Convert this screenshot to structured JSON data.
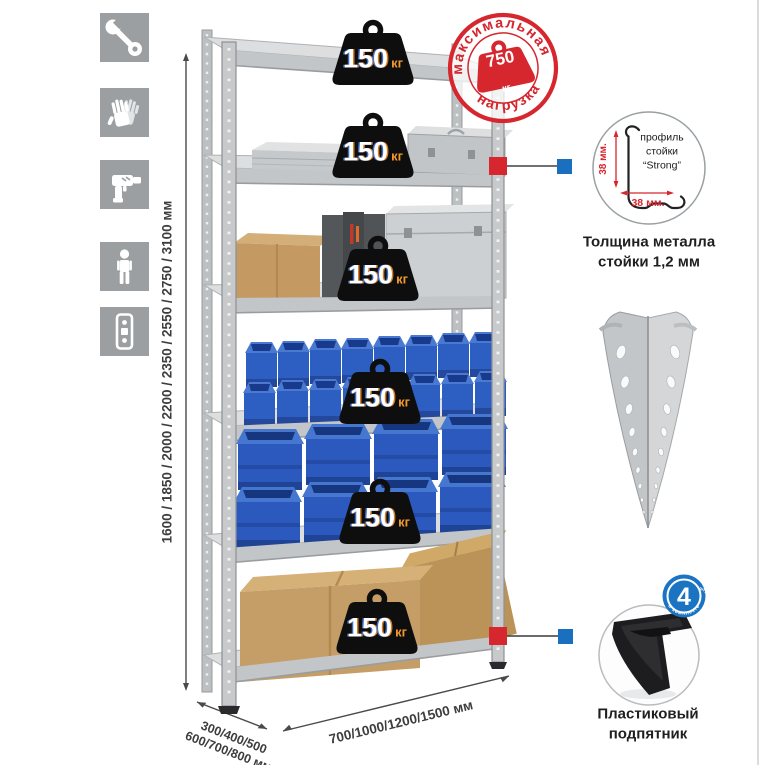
{
  "left_toolbar": {
    "icons": [
      {
        "name": "wrench"
      },
      {
        "name": "gloves"
      },
      {
        "name": "drill"
      },
      {
        "name": "person"
      },
      {
        "name": "level"
      }
    ]
  },
  "dimensions": {
    "height": "1600 / 1850 / 2000 / 2200 / 2350 / 2550 / 2750 / 3100 мм",
    "depth": "300/400/500\n600/700/800 мм",
    "width": "700/1000/1200/1500 мм"
  },
  "rack": {
    "shelves": [
      {
        "load": "150",
        "unit": "кг"
      },
      {
        "load": "150",
        "unit": "кг"
      },
      {
        "load": "150",
        "unit": "кг"
      },
      {
        "load": "150",
        "unit": "кг"
      },
      {
        "load": "150",
        "unit": "кг"
      },
      {
        "load": "150",
        "unit": "кг"
      }
    ]
  },
  "max_load_stamp": {
    "arc_top": "максимальная",
    "arc_bottom": "нагрузка",
    "value": "750",
    "unit": "кг"
  },
  "profile_detail": {
    "annotation": "профиль\nстойки\n“Strong”",
    "dim_vertical": "38 мм.",
    "dim_horizontal": "38 мм.",
    "caption": "Толщина металла\nстойки 1,2 мм"
  },
  "foot_detail": {
    "badge_count": "4",
    "badge_units": "штуки",
    "badge_arc": "в комплекте",
    "caption": "Пластиковый\nподпятник"
  },
  "colors": {
    "accent_red": "#d6262e",
    "accent_blue": "#1a6fbf",
    "bin_blue": "#2d5ec2",
    "cardboard": "#c59d66",
    "metal_gray": "#c9cccd",
    "icon_gray": "#9b9fa2"
  }
}
